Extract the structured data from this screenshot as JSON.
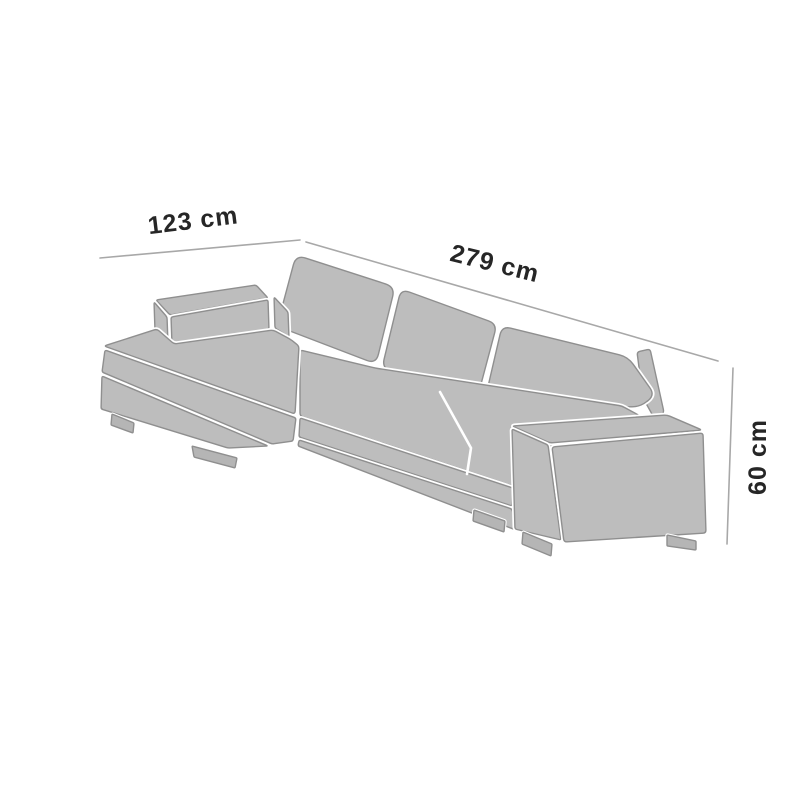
{
  "diagram": {
    "labels": {
      "depth": "123 cm",
      "width": "279 cm",
      "height": "60 cm"
    }
  },
  "colors": {
    "background": "#ffffff",
    "sofa_fill": "#bdbdbd",
    "sofa_outline": "#8f8f8f",
    "foot_fill": "#b5b5b5",
    "dimension_line": "#a8a8a8",
    "label_text": "#262626",
    "seam_gap": "#ffffff"
  }
}
